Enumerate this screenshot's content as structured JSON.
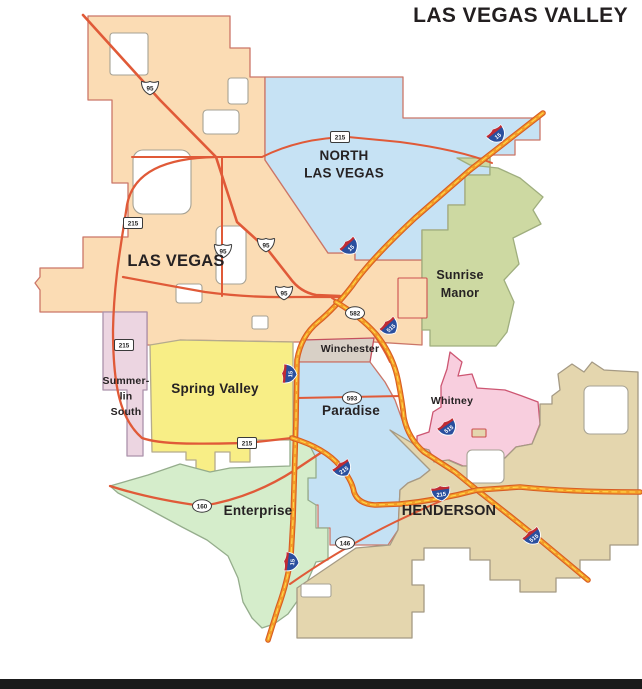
{
  "title": "LAS VEGAS VALLEY",
  "footer_bar_color": "#1b1b1b",
  "map": {
    "background": "#ffffff",
    "colors": {
      "label": "#262223",
      "highway": "#e05a38",
      "interstate_casing": "#d85c22",
      "interstate_fill": "#f39c27",
      "interstate_stripe": "#ffd84d",
      "interstate_blue": "#2a4f9e",
      "interstate_red": "#bf2b33",
      "shield_white": "#ffffff",
      "shield_outline": "#3a3a3a",
      "enclave_outline": "#a6a294"
    },
    "regions": [
      {
        "id": "las-vegas",
        "name": "Las Vegas",
        "fill": "#fbdcb4",
        "stroke": "#cb7668",
        "points": "88,16 230,16 230,48 250,48 250,77 265,77 265,160 328,253 355,253 355,260 422,260 422,345 374,342 303,342 293,342 180,340 178,345 150,345 147,345 147,312 40,312 40,290 35,283 40,277 40,268 83,268 83,237 128,237 128,183 112,183 112,100 88,100"
      },
      {
        "id": "north-las-vegas",
        "name": "North Las Vegas",
        "fill": "#c6e2f4",
        "stroke": "#cb7668",
        "points": "265,77 403,77 403,118 540,118 540,140 515,140 515,155 490,155 490,175 465,175 465,205 448,205 448,230 422,230 422,260 355,260 355,253 328,253 265,160"
      },
      {
        "id": "sunrise-manor",
        "name": "Sunrise Manor",
        "fill": "#cdd9a2",
        "stroke": "#9fae7e",
        "points": "457,158 470,165 498,168 520,178 543,197 533,210 541,224 513,238 519,264 504,280 514,302 507,332 496,346 430,346 430,330 422,330 422,230 448,230 448,205 465,205 465,175 490,175 490,158"
      },
      {
        "id": "winchester",
        "name": "Winchester",
        "fill": "#d8d0c6",
        "stroke": "#c5505e",
        "points": "303,340 374,338 370,362 296,362"
      },
      {
        "id": "paradise",
        "name": "Paradise",
        "fill": "#c4e1f4",
        "stroke": "#cb7668",
        "points": "296,362 370,362 385,382 395,400 404,425 412,442 415,448 428,452 432,462 430,470 420,478 408,483 400,490 398,530 388,545 330,545 330,528 318,528 318,505 308,505 308,490 298,490 296,470"
      },
      {
        "id": "whitney",
        "name": "Whitney",
        "fill": "#f8cede",
        "stroke": "#cd5672",
        "points": "450,352 462,362 458,376 472,374 477,388 505,390 522,396 538,402 540,424 532,444 516,447 505,458 484,466 463,466 449,460 436,463 429,450 417,447 417,436 429,432 433,412 441,407 441,386 447,369"
      },
      {
        "id": "summerlin-south",
        "name": "Summerlin South",
        "fill": "#ecd5e1",
        "stroke": "#ab92ab",
        "points": "103,312 147,312 147,390 143,390 143,456 127,456 127,390 103,390"
      },
      {
        "id": "spring-valley",
        "name": "Spring Valley",
        "fill": "#f8ee86",
        "stroke": "#b5ab8d",
        "points": "150,345 180,340 293,342 293,440 250,440 250,462 230,462 230,452 215,452 215,478 196,478 196,460 186,460 186,452 152,452"
      },
      {
        "id": "enterprise",
        "name": "Enterprise",
        "fill": "#d5edcb",
        "stroke": "#95ad8c",
        "points": "110,486 148,475 180,464 210,472 230,468 290,466 290,436 308,442 316,458 316,478 308,478 308,500 316,505 316,528 328,528 328,560 316,562 308,580 298,600 288,614 274,624 262,628 252,618 243,602 238,578 228,556 207,540 182,527 156,513 132,500 118,493"
      },
      {
        "id": "henderson",
        "name": "Henderson",
        "fill": "#e4d6ae",
        "stroke": "#a59a84",
        "points": "390,430 412,443 417,447 429,450 434,462 448,460 462,466 484,466 505,458 516,447 532,444 540,425 540,404 552,404 552,396 560,390 558,374 572,364 584,372 592,362 604,370 638,372 638,545 610,545 610,560 580,560 580,578 556,578 556,592 520,592 520,580 490,580 490,560 470,560 470,548 424,548 424,560 412,560 412,585 424,585 424,612 412,612 412,638 297,638 297,588 356,548 390,545 398,530 400,490 408,483 420,478 430,470"
      }
    ],
    "enclaves": [
      {
        "x": 110,
        "y": 33,
        "w": 38,
        "h": 42,
        "rx": 3
      },
      {
        "x": 133,
        "y": 150,
        "w": 58,
        "h": 64,
        "rx": 10
      },
      {
        "x": 228,
        "y": 78,
        "w": 20,
        "h": 26,
        "rx": 3
      },
      {
        "x": 203,
        "y": 110,
        "w": 36,
        "h": 24,
        "rx": 4
      },
      {
        "x": 216,
        "y": 226,
        "w": 30,
        "h": 58,
        "rx": 6
      },
      {
        "x": 252,
        "y": 316,
        "w": 16,
        "h": 13,
        "rx": 2
      },
      {
        "x": 176,
        "y": 284,
        "w": 26,
        "h": 19,
        "rx": 3
      },
      {
        "x": 584,
        "y": 386,
        "w": 44,
        "h": 48,
        "rx": 6
      },
      {
        "x": 467,
        "y": 450,
        "w": 37,
        "h": 33,
        "rx": 5
      },
      {
        "x": 301,
        "y": 584,
        "w": 30,
        "h": 13,
        "rx": 2
      },
      {
        "x": 398,
        "y": 278,
        "w": 29,
        "h": 40,
        "rx": 1,
        "fill": "#fbdcb4",
        "stroke": "#cc4f4f",
        "name": "nellis-area"
      },
      {
        "x": 472,
        "y": 429,
        "w": 14,
        "h": 8,
        "rx": 1,
        "fill": "#e4d6ae",
        "stroke": "#cc4f4f",
        "name": "whitney-annex"
      }
    ],
    "roads": [
      {
        "id": "us-95-northwest",
        "type": "highway",
        "w": 2.6,
        "d": "M 83,15 L 160,100 L 216,157 L 237,222 L 268,250 L 290,278 Q 300,292 316,295 L 340,296"
      },
      {
        "id": "us-95-expressway",
        "type": "highway",
        "w": 2.3,
        "d": "M 123,277 Q 160,284 205,292 Q 250,298 295,297 L 340,297"
      },
      {
        "id": "rancho-drive-95",
        "type": "highway",
        "w": 2,
        "d": "M 222,158 L 222,296"
      },
      {
        "id": "craig-road-215",
        "type": "highway",
        "w": 2,
        "d": "M 132,157 L 262,157 Q 300,138 348,137 L 400,142 Q 460,150 492,163"
      },
      {
        "id": "cc-215-beltway",
        "type": "highway",
        "w": 2.3,
        "d": "M 216,157 C 165,158 133,172 127,205 C 121,245 114,280 113,330 C 113,388 121,420 142,438 C 162,445 200,444 247,443 L 292,438"
      },
      {
        "id": "sr-160",
        "type": "highway",
        "w": 2.3,
        "d": "M 110,486 Q 150,499 202,506 Q 252,498 295,470 Q 310,460 322,452"
      },
      {
        "id": "sr-146",
        "type": "highway",
        "w": 2,
        "d": "M 290,584 Q 340,549 395,522 Q 435,503 462,492"
      },
      {
        "id": "sr-582",
        "type": "highway",
        "w": 2,
        "d": "M 332,298 Q 356,312 372,332 Q 383,347 390,362"
      },
      {
        "id": "sr-593",
        "type": "highway",
        "w": 2,
        "d": "M 296,398 L 402,396"
      },
      {
        "id": "i-15",
        "type": "interstate",
        "d": "M 543,113 L 470,170 L 415,218 Q 370,260 352,286 Q 335,308 318,322 Q 301,336 297,360 L 296,420 L 293,520 L 291,556 Q 288,580 278,608 L 268,640"
      },
      {
        "id": "i-515",
        "type": "interstate",
        "d": "M 336,302 Q 360,316 376,334 Q 393,355 398,380 Q 402,400 404,418 Q 408,438 424,452 L 455,472 L 477,490 L 510,516 L 540,540 L 588,580"
      },
      {
        "id": "i-215",
        "type": "interstate",
        "d": "M 292,438 Q 325,448 340,466 Q 352,480 354,492 Q 358,504 375,505 L 400,504 Q 440,500 477,490 L 520,487 Q 570,492 640,492"
      }
    ],
    "shields": [
      {
        "type": "us",
        "label": "95",
        "x": 150,
        "y": 88
      },
      {
        "type": "us",
        "label": "95",
        "x": 223,
        "y": 251
      },
      {
        "type": "us",
        "label": "95",
        "x": 266,
        "y": 245
      },
      {
        "type": "us",
        "label": "95",
        "x": 284,
        "y": 293
      },
      {
        "type": "rect",
        "label": "215",
        "x": 133,
        "y": 223
      },
      {
        "type": "rect",
        "label": "215",
        "x": 124,
        "y": 345
      },
      {
        "type": "rect",
        "label": "215",
        "x": 247,
        "y": 443
      },
      {
        "type": "rect",
        "label": "215",
        "x": 340,
        "y": 137
      },
      {
        "type": "oval",
        "label": "582",
        "x": 355,
        "y": 313
      },
      {
        "type": "oval",
        "label": "593",
        "x": 352,
        "y": 398
      },
      {
        "type": "oval",
        "label": "160",
        "x": 202,
        "y": 506
      },
      {
        "type": "oval",
        "label": "146",
        "x": 345,
        "y": 543
      },
      {
        "type": "interstate",
        "label": "15",
        "x": 497,
        "y": 135,
        "rot": -38
      },
      {
        "type": "interstate",
        "label": "15",
        "x": 350,
        "y": 247,
        "rot": -42
      },
      {
        "type": "interstate",
        "label": "15",
        "x": 289,
        "y": 374,
        "rot": -85
      },
      {
        "type": "interstate",
        "label": "15",
        "x": 291,
        "y": 562,
        "rot": -83
      },
      {
        "type": "interstate",
        "label": "515",
        "x": 390,
        "y": 327,
        "rot": -42
      },
      {
        "type": "interstate",
        "label": "515",
        "x": 448,
        "y": 428,
        "rot": -35
      },
      {
        "type": "interstate",
        "label": "515",
        "x": 533,
        "y": 537,
        "rot": -38
      },
      {
        "type": "interstate",
        "label": "215",
        "x": 343,
        "y": 469,
        "rot": -35
      },
      {
        "type": "interstate",
        "label": "215",
        "x": 441,
        "y": 493,
        "rot": -8
      }
    ],
    "labels": [
      {
        "id": "north-las-vegas",
        "lines": [
          "NORTH",
          "LAS VEGAS"
        ],
        "x": 344,
        "y": 160,
        "size": 13.5,
        "weight": 700,
        "lh": 17.5
      },
      {
        "id": "las-vegas",
        "lines": [
          "LAS VEGAS"
        ],
        "x": 176,
        "y": 266,
        "size": 16.5,
        "weight": 700
      },
      {
        "id": "sunrise-manor",
        "lines": [
          "Sunrise",
          "Manor"
        ],
        "x": 460,
        "y": 279,
        "size": 12.5,
        "weight": 600,
        "lh": 18
      },
      {
        "id": "summerlin-south",
        "lines": [
          "Summer-",
          "lin",
          "South"
        ],
        "x": 126,
        "y": 384,
        "size": 10.5,
        "weight": 600,
        "lh": 15.5
      },
      {
        "id": "spring-valley",
        "lines": [
          "Spring Valley"
        ],
        "x": 215,
        "y": 393,
        "size": 13.5,
        "weight": 700
      },
      {
        "id": "winchester",
        "lines": [
          "Winchester"
        ],
        "x": 350,
        "y": 352,
        "size": 10.5,
        "weight": 600
      },
      {
        "id": "paradise",
        "lines": [
          "Paradise"
        ],
        "x": 351,
        "y": 415,
        "size": 13.5,
        "weight": 700
      },
      {
        "id": "whitney",
        "lines": [
          "Whitney"
        ],
        "x": 452,
        "y": 404,
        "size": 10.5,
        "weight": 600
      },
      {
        "id": "enterprise",
        "lines": [
          "Enterprise"
        ],
        "x": 258,
        "y": 515,
        "size": 13.5,
        "weight": 700
      },
      {
        "id": "henderson",
        "lines": [
          "HENDERSON"
        ],
        "x": 449,
        "y": 515,
        "size": 14.5,
        "weight": 700
      }
    ]
  }
}
